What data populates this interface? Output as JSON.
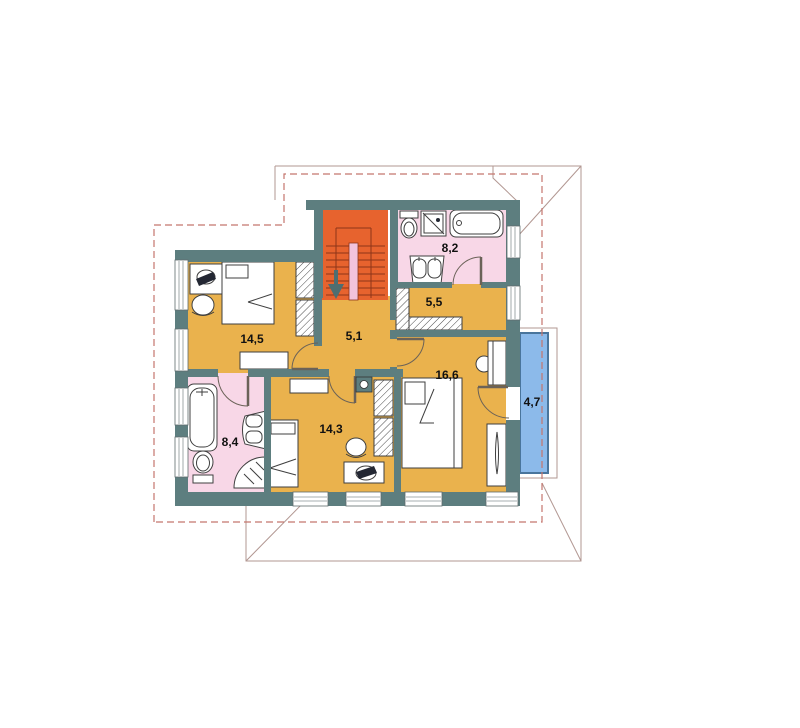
{
  "colors": {
    "wall": "#5d7e7f",
    "room_yellow": "#eab24d",
    "stair_orange": "#e7632e",
    "bath_pink": "#f8d7e7",
    "balcony_blue": "#8cbaea",
    "balcony_border": "#49759c",
    "roof_line": "#b29792",
    "roof_dash": "#c4766d",
    "stair_line": "#8e3418",
    "stair_landing": "#f2c3dc",
    "fixture": "#3f3f3f",
    "chair_dark": "#232733",
    "arrow": "#4e6e71",
    "label": "#111111"
  },
  "rooms": [
    {
      "id": "bedroom-top-left",
      "area": "14,5"
    },
    {
      "id": "hall",
      "area": "5,1"
    },
    {
      "id": "bathroom-top",
      "area": "8,2"
    },
    {
      "id": "closet",
      "area": "5,5"
    },
    {
      "id": "bedroom-right",
      "area": "16,6"
    },
    {
      "id": "balcony",
      "area": "4,7"
    },
    {
      "id": "bathroom-bottom-left",
      "area": "8,4"
    },
    {
      "id": "bedroom-bottom",
      "area": "14,3"
    }
  ]
}
